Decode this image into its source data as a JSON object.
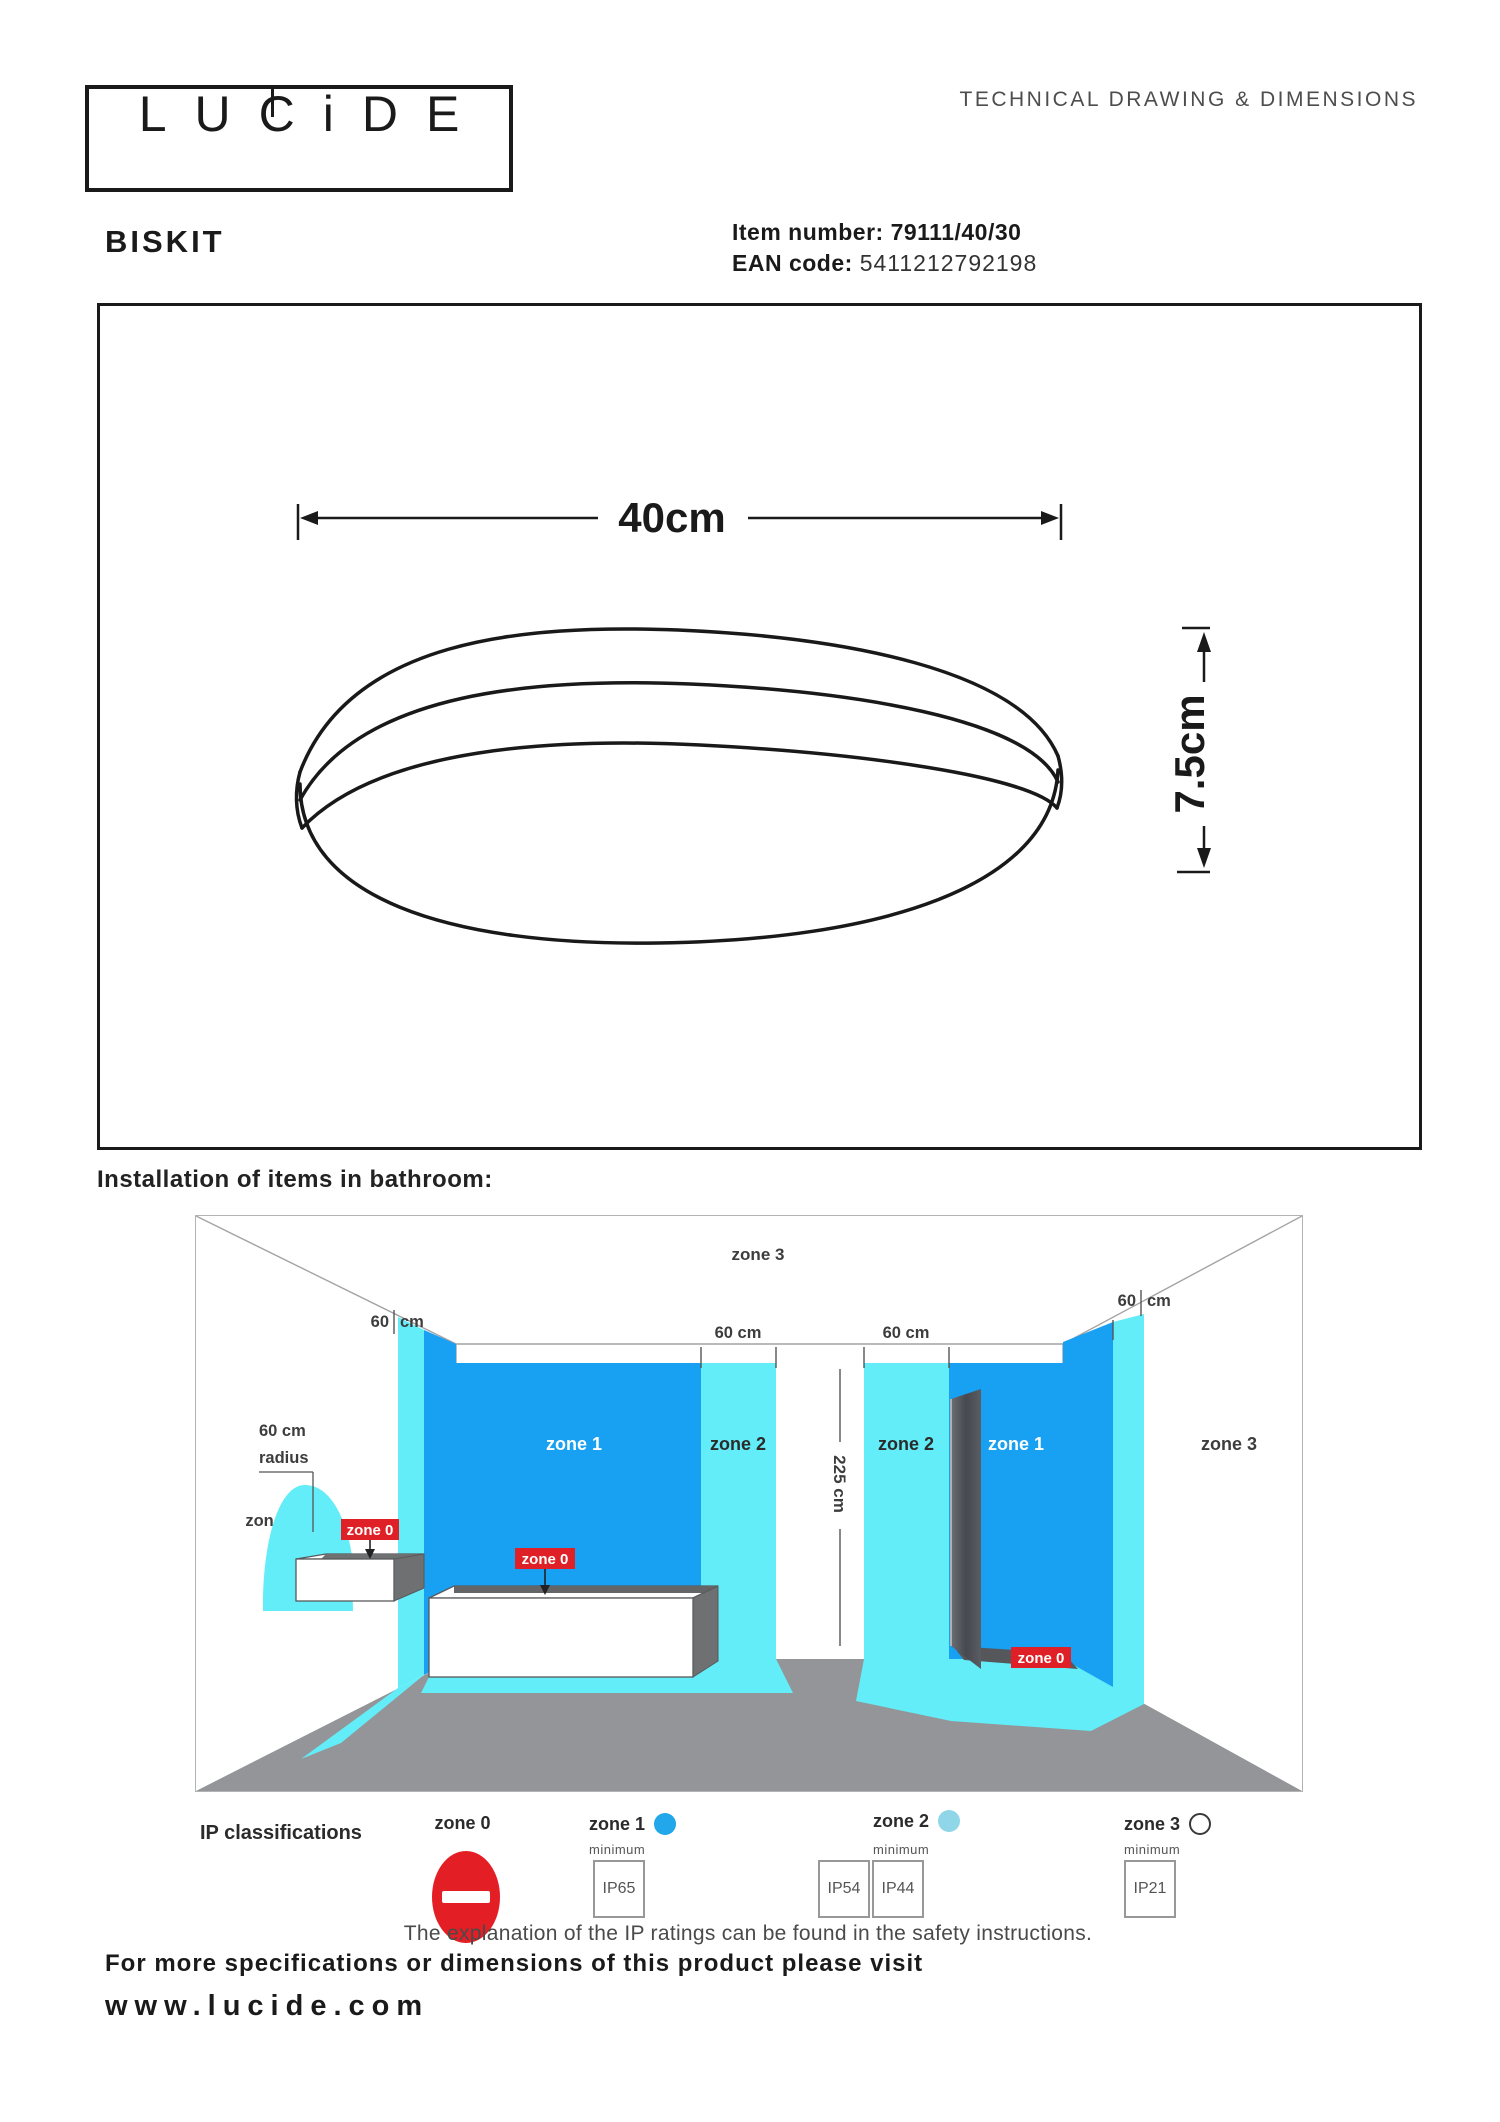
{
  "header": {
    "logo_letters": [
      "L",
      "U",
      "C",
      "i",
      "D",
      "E"
    ],
    "tech_heading": "TECHNICAL DRAWING & DIMENSIONS",
    "product_name": "BISKIT",
    "item_label": "Item number:",
    "item_value": "79111/40/30",
    "ean_label": "EAN code:",
    "ean_value": "5411212792198"
  },
  "drawing": {
    "width_dim": "40cm",
    "height_dim": "7.5cm"
  },
  "bathroom": {
    "title": "Installation of items in bathroom:",
    "zone0": "zone 0",
    "zone1": "zone 1",
    "zone2": "zone 2",
    "zone3": "zone 3",
    "dim60": "60 cm",
    "dim60_num": "60",
    "dim60_unit": "cm",
    "dim225": "225 cm",
    "radius_line1": "60 cm",
    "radius_line2": "radius"
  },
  "legend": {
    "title": "IP classifications",
    "minimum": "minimum",
    "zones": [
      {
        "label": "zone 0"
      },
      {
        "label": "zone 1",
        "ratings": [
          "IP65"
        ]
      },
      {
        "label": "zone 2",
        "ratings": [
          "IP54",
          "IP44"
        ]
      },
      {
        "label": "zone 3",
        "ratings": [
          "IP21"
        ]
      }
    ],
    "note": "The explanation of the IP ratings can be found in the safety instructions."
  },
  "footer": {
    "line1": "For more specifications or dimensions of this product please visit",
    "line2": "www.lucide.com"
  },
  "colors": {
    "zone1_blue": "#18A0F2",
    "zone2_cyan": "#63EDF8",
    "zone0_red": "#E31E24",
    "floor_gray": "#939598"
  }
}
